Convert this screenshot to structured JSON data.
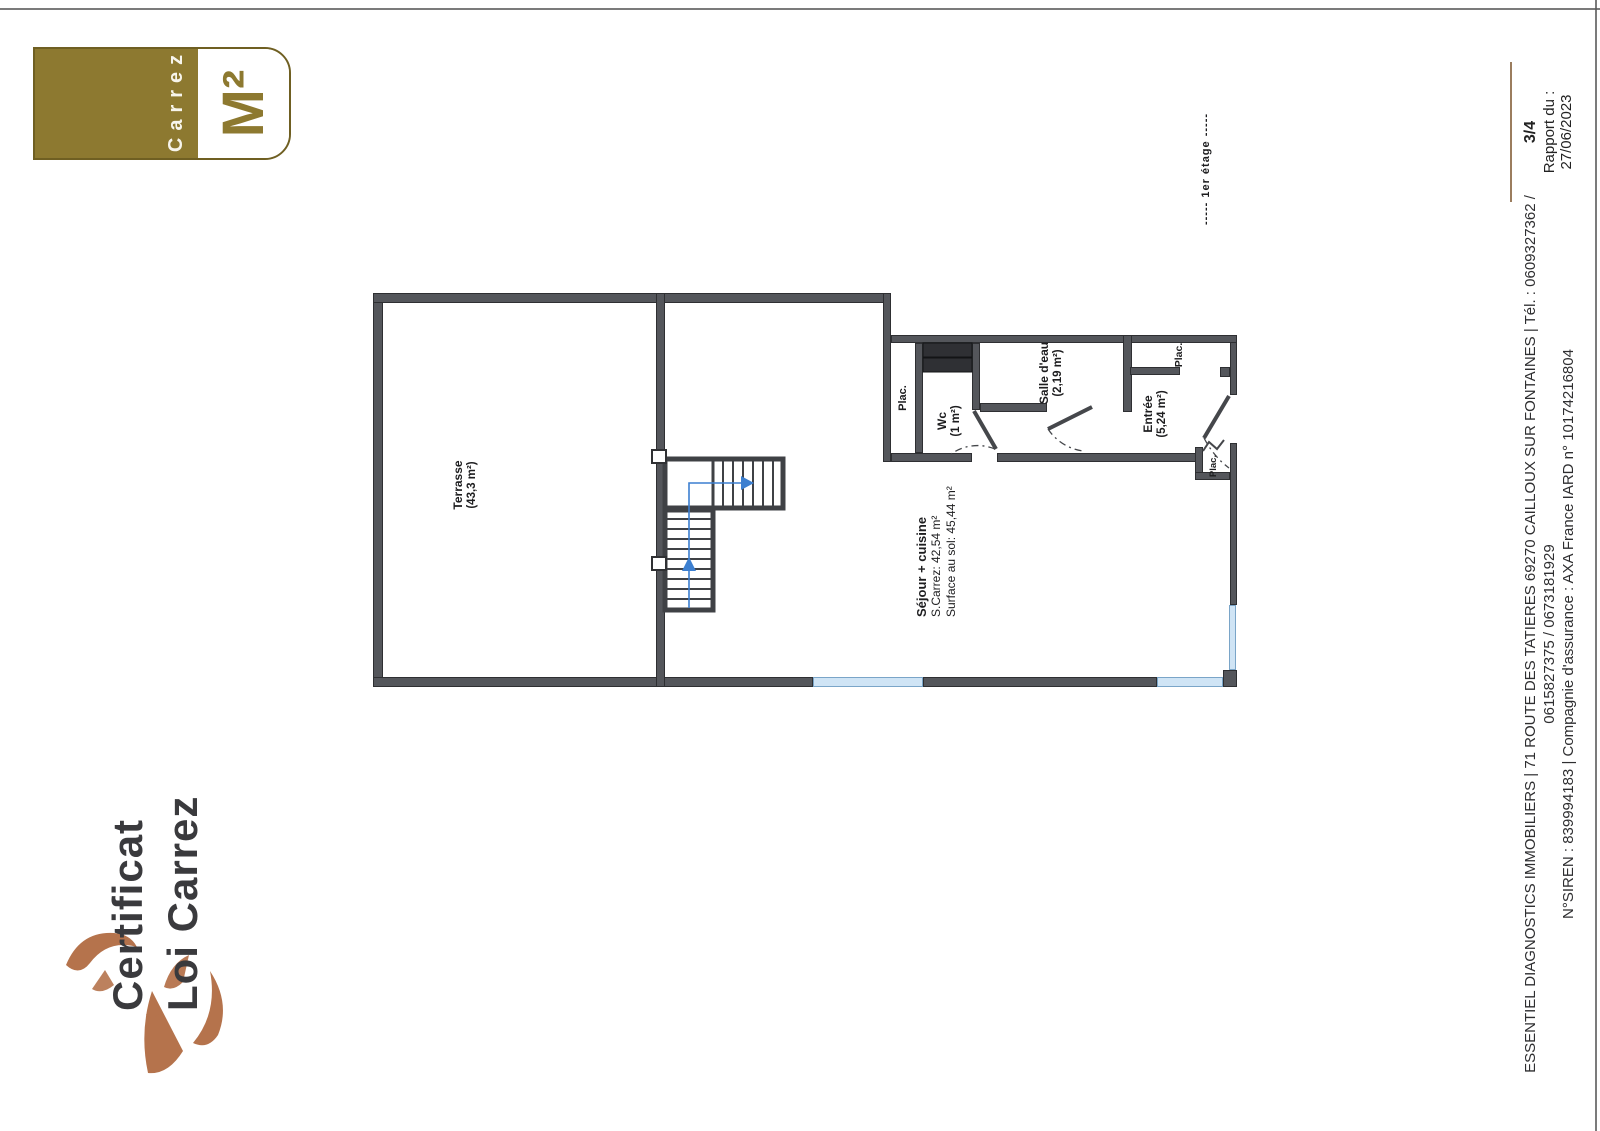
{
  "badge": {
    "brand": "Carrez",
    "unit": "M²"
  },
  "title": {
    "line1": "Certificat",
    "line2": "Loi Carrez"
  },
  "floor_tag": "-----   1er étage   -----",
  "plan": {
    "terrasse_name": "Terrasse",
    "terrasse_area": "(43,3 m²)",
    "sejour_name": "Séjour + cuisine",
    "sejour_carrez": "S.Carrez: 42,54 m²",
    "sejour_floor": "Surface au sol: 45,44 m²",
    "wc_name": "Wc",
    "wc_area": "(1 m²)",
    "salle_eau_name": "Salle d'eau",
    "salle_eau_area": "(2,19 m²)",
    "entree_name": "Entrée",
    "entree_area": "(5,24 m²)",
    "plac_label": "Plac."
  },
  "footer": {
    "line1": "ESSENTIEL DIAGNOSTICS IMMOBILIERS | 71 ROUTE DES TATIERES 69270 CAILLOUX SUR FONTAINES | Tél. : 0609327362 /",
    "line2": "0615827375 / 0673181929",
    "line3": "N°SIREN : 839994183 | Compagnie d'assurance : AXA France IARD n° 10174216804"
  },
  "report": {
    "page": "3/4",
    "label": "Rapport du :",
    "date": "27/06/2023"
  },
  "colors": {
    "gold": "#8d7930",
    "copper": "#b5734c",
    "ink": "#3a3a3d",
    "wall": "#54565b",
    "window_blue": "#cfe4f5",
    "stair_arrow": "#3c7fd0"
  }
}
